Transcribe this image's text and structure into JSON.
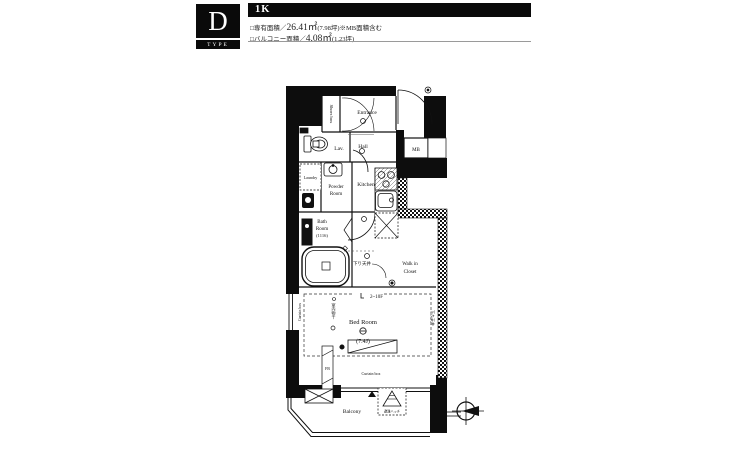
{
  "header": {
    "type_letter": "D",
    "type_label": "TYPE",
    "layout_type": "1K",
    "spec1_prefix": "□専有面積／",
    "spec1_value": "26.41㎡",
    "spec1_suffix": "(7.98坪)※MB面積含む",
    "spec2_prefix": "□バルコニー面積／",
    "spec2_value": "4.08㎡",
    "spec2_suffix": "(1.23坪)"
  },
  "floorplan": {
    "rooms": {
      "entrance": "Entrance",
      "shoes_box": "Shoes box",
      "hall": "Hall",
      "lavatory": "Lav.",
      "meter_box": "MB",
      "laundry": "Laundry",
      "powder1": "Powder",
      "powder2": "Room",
      "kitchen": "Kitchen",
      "bath1": "Bath",
      "bath2": "Room",
      "bath3": "(1116)",
      "wic1": "Walk in",
      "wic2": "Closet",
      "bedroom": "Bed Room",
      "bedroom_size": "(7.4J)",
      "balcony": "Balcony"
    },
    "notes": {
      "floor_range": "2~10F",
      "curtain_box_bottom": "Curtain box",
      "curtain_box_side": "Curtain box",
      "lowered_ceiling": "下り天井",
      "lowered_ceiling_side": "下り天井",
      "indoor_drying": "室内物干",
      "flower_box": "FB",
      "escape_hatch": "避難ハッチ"
    },
    "colors": {
      "wall": "#0d0d0d",
      "line": "#111111"
    }
  }
}
